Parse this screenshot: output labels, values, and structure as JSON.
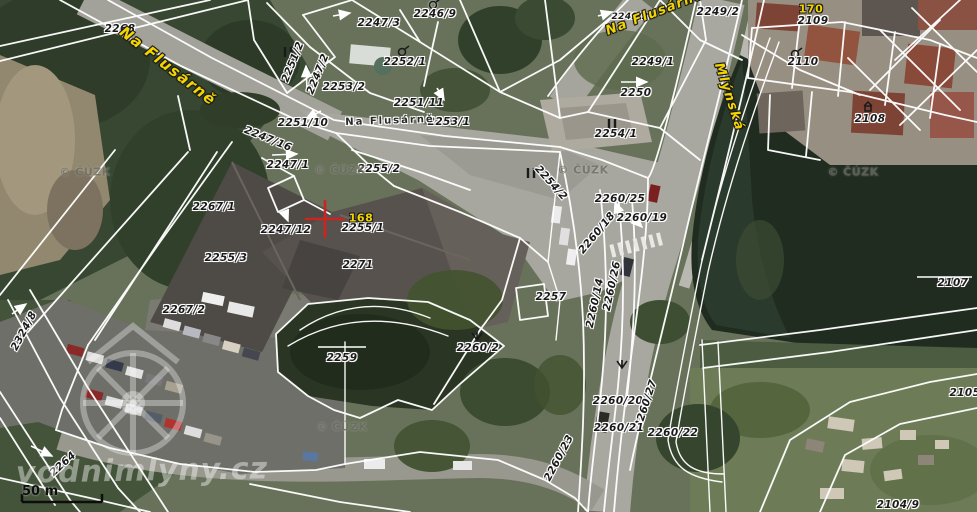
{
  "map": {
    "colors": {
      "street_name_color": "#f2d400",
      "parcel_label_color": "#1a1a1a",
      "cadastral_line_color": "#ffffff",
      "red_cross_color": "#cc2420"
    },
    "street_labels": [
      {
        "text": "Na Flusárně",
        "x": 168,
        "y": 66,
        "rot": 38,
        "size": 15
      },
      {
        "text": "Na Flusárně",
        "x": 655,
        "y": 13,
        "rot": -21,
        "size": 13
      },
      {
        "text": "Mlýnská",
        "x": 729,
        "y": 97,
        "rot": 72,
        "size": 13
      }
    ],
    "street_center_label": {
      "text": "Na Flusárně",
      "x": 390,
      "y": 121,
      "rot": -2
    },
    "house_numbers": [
      {
        "text": "170",
        "x": 811,
        "y": 9
      },
      {
        "text": "168",
        "x": 361,
        "y": 218
      }
    ],
    "parcel_labels": [
      {
        "text": "2268",
        "x": 120,
        "y": 29
      },
      {
        "text": "2247/3",
        "x": 379,
        "y": 23
      },
      {
        "text": "2246/9",
        "x": 435,
        "y": 14
      },
      {
        "text": "2249/2",
        "x": 630,
        "y": 17,
        "size": 9
      },
      {
        "text": "2249/2",
        "x": 718,
        "y": 12
      },
      {
        "text": "2109",
        "x": 813,
        "y": 21
      },
      {
        "text": "2110",
        "x": 803,
        "y": 62
      },
      {
        "text": "2251/2",
        "x": 293,
        "y": 62,
        "rot": -68
      },
      {
        "text": "2247/2",
        "x": 318,
        "y": 74,
        "rot": -68
      },
      {
        "text": "2252/1",
        "x": 405,
        "y": 62
      },
      {
        "text": "2253/2",
        "x": 344,
        "y": 87
      },
      {
        "text": "2251/11",
        "x": 419,
        "y": 103
      },
      {
        "text": "2251/10",
        "x": 303,
        "y": 123
      },
      {
        "text": "2253/1",
        "x": 449,
        "y": 122
      },
      {
        "text": "2249/1",
        "x": 653,
        "y": 62
      },
      {
        "text": "2250",
        "x": 636,
        "y": 93
      },
      {
        "text": "2254/1",
        "x": 616,
        "y": 134
      },
      {
        "text": "2108",
        "x": 870,
        "y": 119
      },
      {
        "text": "2247/16",
        "x": 268,
        "y": 139,
        "rot": 22
      },
      {
        "text": "2247/1",
        "x": 288,
        "y": 165
      },
      {
        "text": "2267/1",
        "x": 214,
        "y": 207
      },
      {
        "text": "2247/12",
        "x": 286,
        "y": 230
      },
      {
        "text": "2255/3",
        "x": 226,
        "y": 258
      },
      {
        "text": "2255/2",
        "x": 379,
        "y": 169
      },
      {
        "text": "2255/1",
        "x": 363,
        "y": 228
      },
      {
        "text": "2271",
        "x": 358,
        "y": 265
      },
      {
        "text": "2254/2",
        "x": 551,
        "y": 183,
        "rot": 48
      },
      {
        "text": "2260/25",
        "x": 620,
        "y": 199
      },
      {
        "text": "2260/19",
        "x": 642,
        "y": 218
      },
      {
        "text": "2260/18",
        "x": 597,
        "y": 233,
        "rot": -50
      },
      {
        "text": "2257",
        "x": 551,
        "y": 297
      },
      {
        "text": "2260/26",
        "x": 612,
        "y": 286,
        "rot": -78
      },
      {
        "text": "2260/14",
        "x": 595,
        "y": 303,
        "rot": -78
      },
      {
        "text": "2267/2",
        "x": 184,
        "y": 310
      },
      {
        "text": "2324/8",
        "x": 24,
        "y": 331,
        "rot": -62
      },
      {
        "text": "2259",
        "x": 342,
        "y": 358
      },
      {
        "text": "2260/2",
        "x": 478,
        "y": 348
      },
      {
        "text": "2264",
        "x": 63,
        "y": 464,
        "rot": -42
      },
      {
        "text": "2260/20",
        "x": 618,
        "y": 401
      },
      {
        "text": "2260/27",
        "x": 646,
        "y": 404,
        "rot": -72
      },
      {
        "text": "2260/21",
        "x": 619,
        "y": 428
      },
      {
        "text": "2260/22",
        "x": 673,
        "y": 433
      },
      {
        "text": "2260/23",
        "x": 559,
        "y": 458,
        "rot": -62
      },
      {
        "text": "2107",
        "x": 953,
        "y": 283
      },
      {
        "text": "2105/",
        "x": 967,
        "y": 393
      },
      {
        "text": "2104/9",
        "x": 898,
        "y": 505
      }
    ],
    "watermarks": {
      "cuzk_text": "© ČÚZK",
      "cuzk_positions": [
        {
          "x": 85,
          "y": 172
        },
        {
          "x": 340,
          "y": 170
        },
        {
          "x": 583,
          "y": 170
        },
        {
          "x": 853,
          "y": 172
        },
        {
          "x": 342,
          "y": 427
        }
      ],
      "big_text": "vodnimlyny.cz",
      "big_x": 142,
      "big_y": 471
    },
    "scale_bar": {
      "label": "50 m"
    }
  }
}
